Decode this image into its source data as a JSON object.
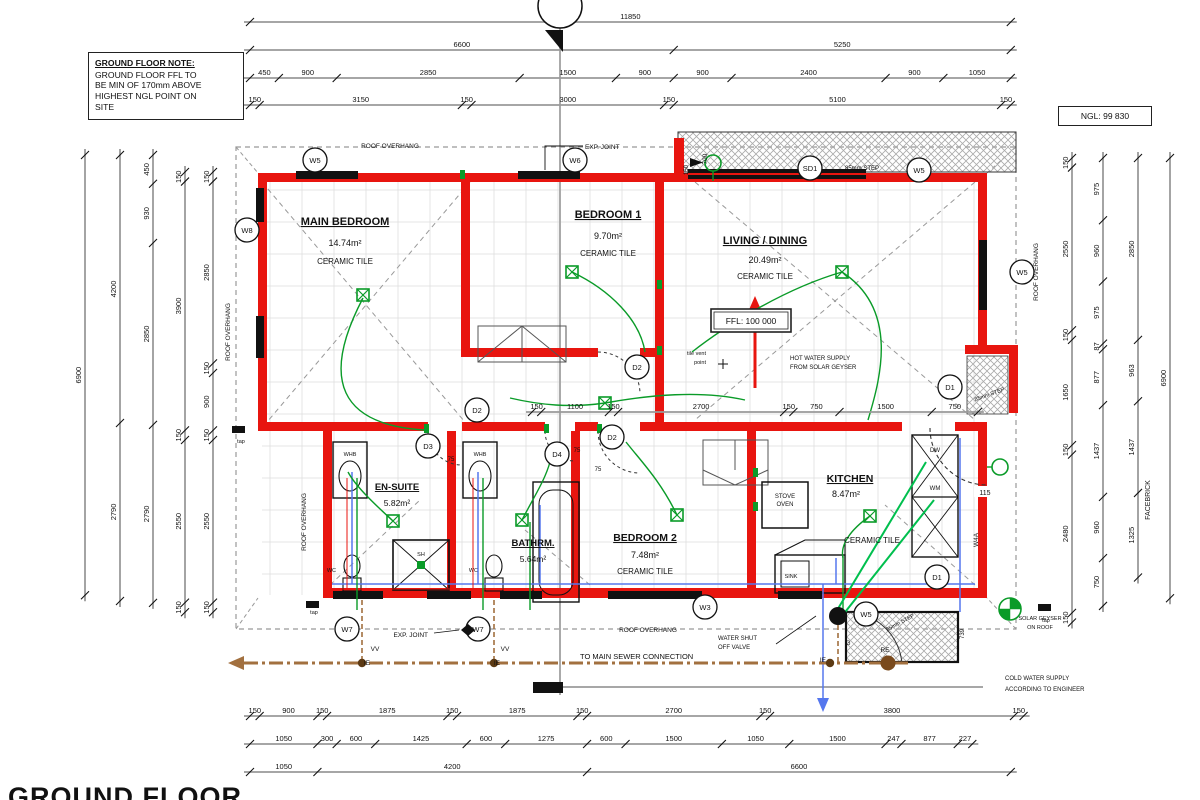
{
  "title": "GROUND FLOOR",
  "note_box": {
    "title": "GROUND FLOOR NOTE:",
    "lines": [
      "GROUND FLOOR FFL TO",
      "BE MIN OF 170mm ABOVE",
      "HIGHEST NGL POINT ON",
      "SITE"
    ]
  },
  "ngl_label": "NGL: 99 830",
  "ffl_label": "FFL: 100 000",
  "rooms": [
    {
      "name": "MAIN BEDROOM",
      "area": "14.74m²",
      "finish": "CERAMIC TILE"
    },
    {
      "name": "BEDROOM 1",
      "area": "9.70m²",
      "finish": "CERAMIC TILE"
    },
    {
      "name": "LIVING / DINING",
      "area": "20.49m²",
      "finish": "CERAMIC TILE"
    },
    {
      "name": "KITCHEN",
      "area": "8.47m²",
      "finish": "CERAMIC TILE"
    },
    {
      "name": "EN-SUITE",
      "area": "5.82m²"
    },
    {
      "name": "BATHRM.",
      "area": "5.64m²"
    },
    {
      "name": "BEDROOM 2",
      "area": "7.48m²",
      "finish": "CERAMIC TILE"
    }
  ],
  "fixtures": {
    "whb": "WHB",
    "wc": "WC",
    "shower": "SH",
    "sink": "SINK",
    "stove": [
      "STOVE",
      "OVEN"
    ],
    "dishwasher": "DW",
    "washing_machine": "WM"
  },
  "markers": [
    "W5",
    "W6",
    "W8",
    "SD1",
    "W5",
    "W5",
    "D1",
    "D2",
    "D2",
    "D3",
    "D4",
    "D2",
    "W7",
    "W7",
    "W3",
    "W5",
    "D1"
  ],
  "labels": {
    "roof_overhang": "ROOF OVERHANG",
    "exp_joint": "EXP. JOINT",
    "step_85": "85mm STEP",
    "sewer_note": "TO MAIN SEWER CONNECTION",
    "shutoff": [
      "WATER SHUT",
      "OFF VALVE"
    ],
    "cold": [
      "COLD WATER SUPPLY",
      "ACCORDING TO ENGINEER"
    ],
    "hot": [
      "HOT WATER SUPPLY",
      "FROM SOLAR GEYSER"
    ],
    "solar": [
      "SOLAR GEYSER",
      "ON ROOF"
    ],
    "tile_vent": [
      "tile vent",
      "point"
    ],
    "facebrick": "FACEBRICK",
    "tap": "tap",
    "vv": "VV",
    "ie": "IE",
    "g": "G",
    "re": "RE",
    "d115": "115",
    "d75": "75",
    "d700": "700",
    "d739": "739",
    "d150": "150",
    "w4a": "W4A"
  },
  "dimensions": {
    "top": [
      [
        11850
      ],
      [
        6600,
        5250
      ],
      [
        450,
        900,
        2850,
        1500,
        900,
        900,
        2400,
        900,
        1050
      ],
      [
        150,
        3150,
        150,
        3000,
        150,
        5100,
        150
      ]
    ],
    "bottom": [
      [
        150,
        900,
        150,
        1875,
        150,
        1875,
        150,
        2700,
        150,
        3800,
        150
      ],
      [
        1050,
        300,
        600,
        1425,
        600,
        1275,
        600,
        1500,
        1050,
        1500,
        247,
        877,
        227
      ],
      [
        1050,
        4200,
        6600
      ]
    ],
    "left": [
      [
        6900
      ],
      [
        4200,
        2790
      ],
      [
        450,
        930,
        2850,
        2790
      ],
      [
        150,
        3900,
        150,
        2550,
        150
      ],
      [
        150,
        2850,
        150,
        900,
        150,
        2550,
        150
      ]
    ],
    "right": [
      [
        150,
        2550,
        150,
        1650,
        150,
        2480,
        150
      ],
      [
        975,
        960,
        975,
        87,
        877,
        1437,
        960,
        750
      ],
      [
        2850,
        963,
        1437,
        1325
      ],
      [
        6900
      ]
    ],
    "middle": [
      150,
      1100,
      150,
      2700,
      150,
      750,
      1500,
      750
    ]
  },
  "colors": {
    "wall": "#e8150f",
    "window": "#111111",
    "electrical": "#0a9b28",
    "electrical_bright": "#00bf4e",
    "cold_water": "#5577ee",
    "hot_water": "#e8150f",
    "sewer": "#a2703f",
    "dim_line": "#9a9a9a"
  }
}
